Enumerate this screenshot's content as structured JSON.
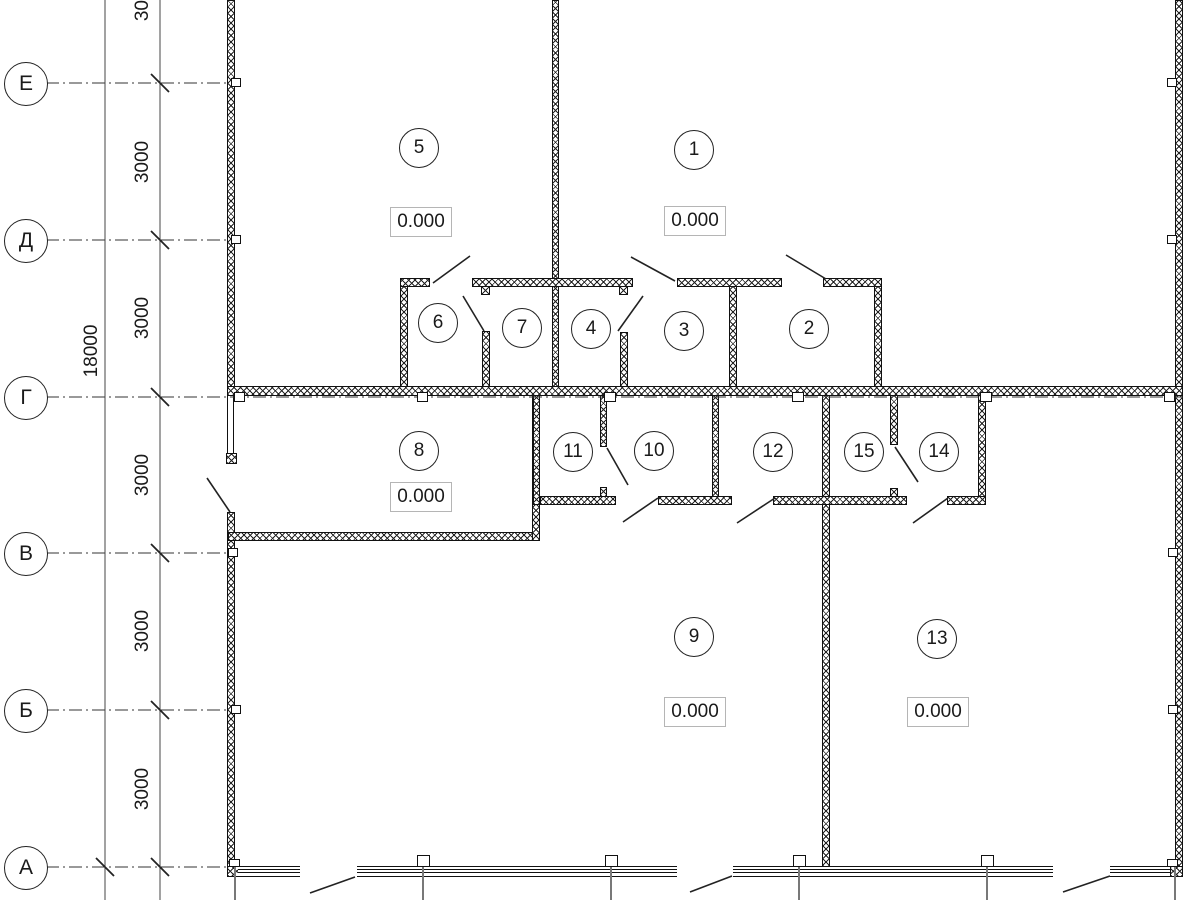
{
  "drawing": {
    "type": "architectural-floor-plan",
    "axes": [
      {
        "label": "Е"
      },
      {
        "label": "Д"
      },
      {
        "label": "Г"
      },
      {
        "label": "В"
      },
      {
        "label": "Б"
      },
      {
        "label": "А"
      }
    ],
    "dim_overall": "18000",
    "dim_bays": [
      "3000",
      "3000",
      "3000",
      "3000",
      "3000",
      "3000"
    ],
    "rooms": [
      {
        "number": "5"
      },
      {
        "number": "1"
      },
      {
        "number": "6"
      },
      {
        "number": "7"
      },
      {
        "number": "4"
      },
      {
        "number": "3"
      },
      {
        "number": "2"
      },
      {
        "number": "8"
      },
      {
        "number": "11"
      },
      {
        "number": "10"
      },
      {
        "number": "12"
      },
      {
        "number": "15"
      },
      {
        "number": "14"
      },
      {
        "number": "9"
      },
      {
        "number": "13"
      }
    ],
    "elevations": [
      "0.000",
      "0.000",
      "0.000",
      "0.000",
      "0.000"
    ],
    "colors": {
      "line": "#111111",
      "elevation_box_border": "#b5b5b5",
      "guide_gray": "#787878"
    }
  }
}
